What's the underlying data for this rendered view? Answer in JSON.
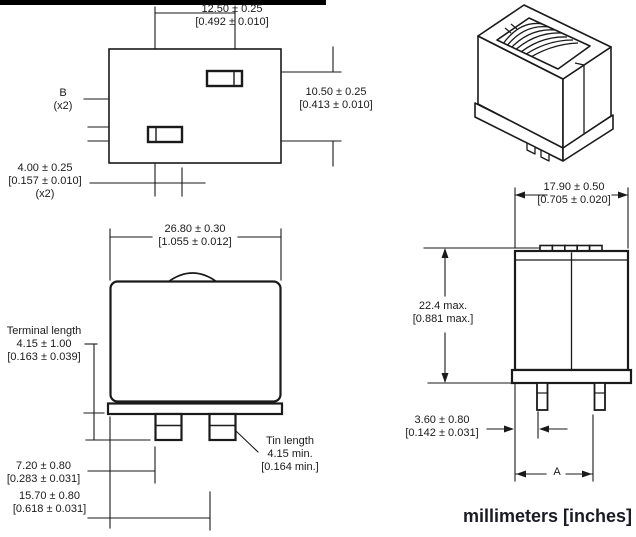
{
  "title": "Component outline dimension drawing",
  "colors": {
    "line": "#1a1a1a",
    "top_bar": "#000000",
    "background": "#ffffff",
    "footer_text": "#1b1b26"
  },
  "footer": {
    "units_label": "millimeters [inches]"
  },
  "views": {
    "top_view": {
      "dim_width": {
        "mm": "12.50 ± 0.25",
        "in": "[0.492 ± 0.010]"
      },
      "dim_height": {
        "mm": "10.50 ± 0.25",
        "in": "[0.413 ± 0.010]"
      },
      "label_b": {
        "name": "B",
        "qty": "(x2)"
      },
      "dim_terminal": {
        "mm": "4.00 ± 0.25",
        "in": "[0.157 ± 0.010]",
        "qty": "(x2)"
      }
    },
    "front_view": {
      "dim_width": {
        "mm": "26.80 ± 0.30",
        "in": "[1.055 ± 0.012]"
      },
      "terminal_length": {
        "label": "Terminal length",
        "mm": "4.15 ± 1.00",
        "in": "[0.163 ± 0.039]"
      },
      "tin_length": {
        "label": "Tin length",
        "mm": "4.15 min.",
        "in": "[0.164 min.]"
      },
      "dim_pin1_offset": {
        "mm": "7.20 ± 0.80",
        "in": "[0.283 ± 0.031]"
      },
      "dim_pin2_offset": {
        "mm": "15.70 ± 0.80",
        "in": "[0.618 ± 0.031]"
      }
    },
    "side_view": {
      "dim_width": {
        "mm": "17.90 ± 0.50",
        "in": "[0.705 ± 0.020]"
      },
      "dim_height": {
        "mm": "22.4 max.",
        "in": "[0.881 max.]"
      },
      "dim_pin_offset": {
        "mm": "3.60 ± 0.80",
        "in": "[0.142 ± 0.031]"
      },
      "dim_a": {
        "label": "A"
      }
    }
  }
}
